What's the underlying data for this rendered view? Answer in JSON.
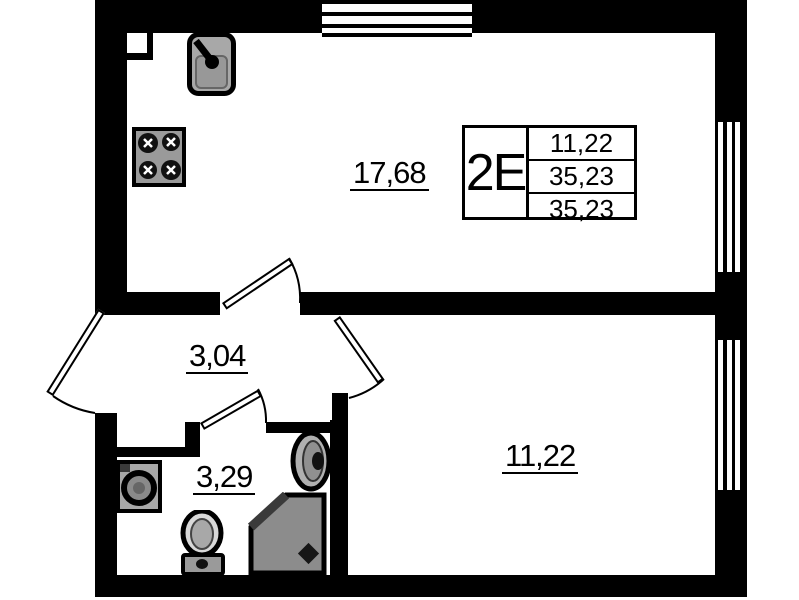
{
  "plan": {
    "type": "apartment-floor-plan",
    "rooms": {
      "kitchen_living": {
        "area": "17,68"
      },
      "hallway": {
        "area": "3,04"
      },
      "bathroom": {
        "area": "3,29"
      },
      "bedroom": {
        "area": "11,22"
      }
    },
    "stamp": {
      "unit_type": "2Е",
      "rows": [
        "11,22",
        "35,23",
        "35,23"
      ]
    },
    "fixtures": [
      "kitchen-sink",
      "cooktop",
      "washing-machine",
      "toilet",
      "wash-basin",
      "corner-shower"
    ],
    "windows": [
      "top-window",
      "right-window-1",
      "right-window-2"
    ],
    "doors": [
      "entry-door",
      "kitchen-door",
      "bathroom-door",
      "bedroom-door"
    ],
    "colors": {
      "walls": "#000000",
      "background": "#ffffff",
      "fixture_gray": "#a3a3a3",
      "shower_gray": "#8c8c8c"
    }
  }
}
